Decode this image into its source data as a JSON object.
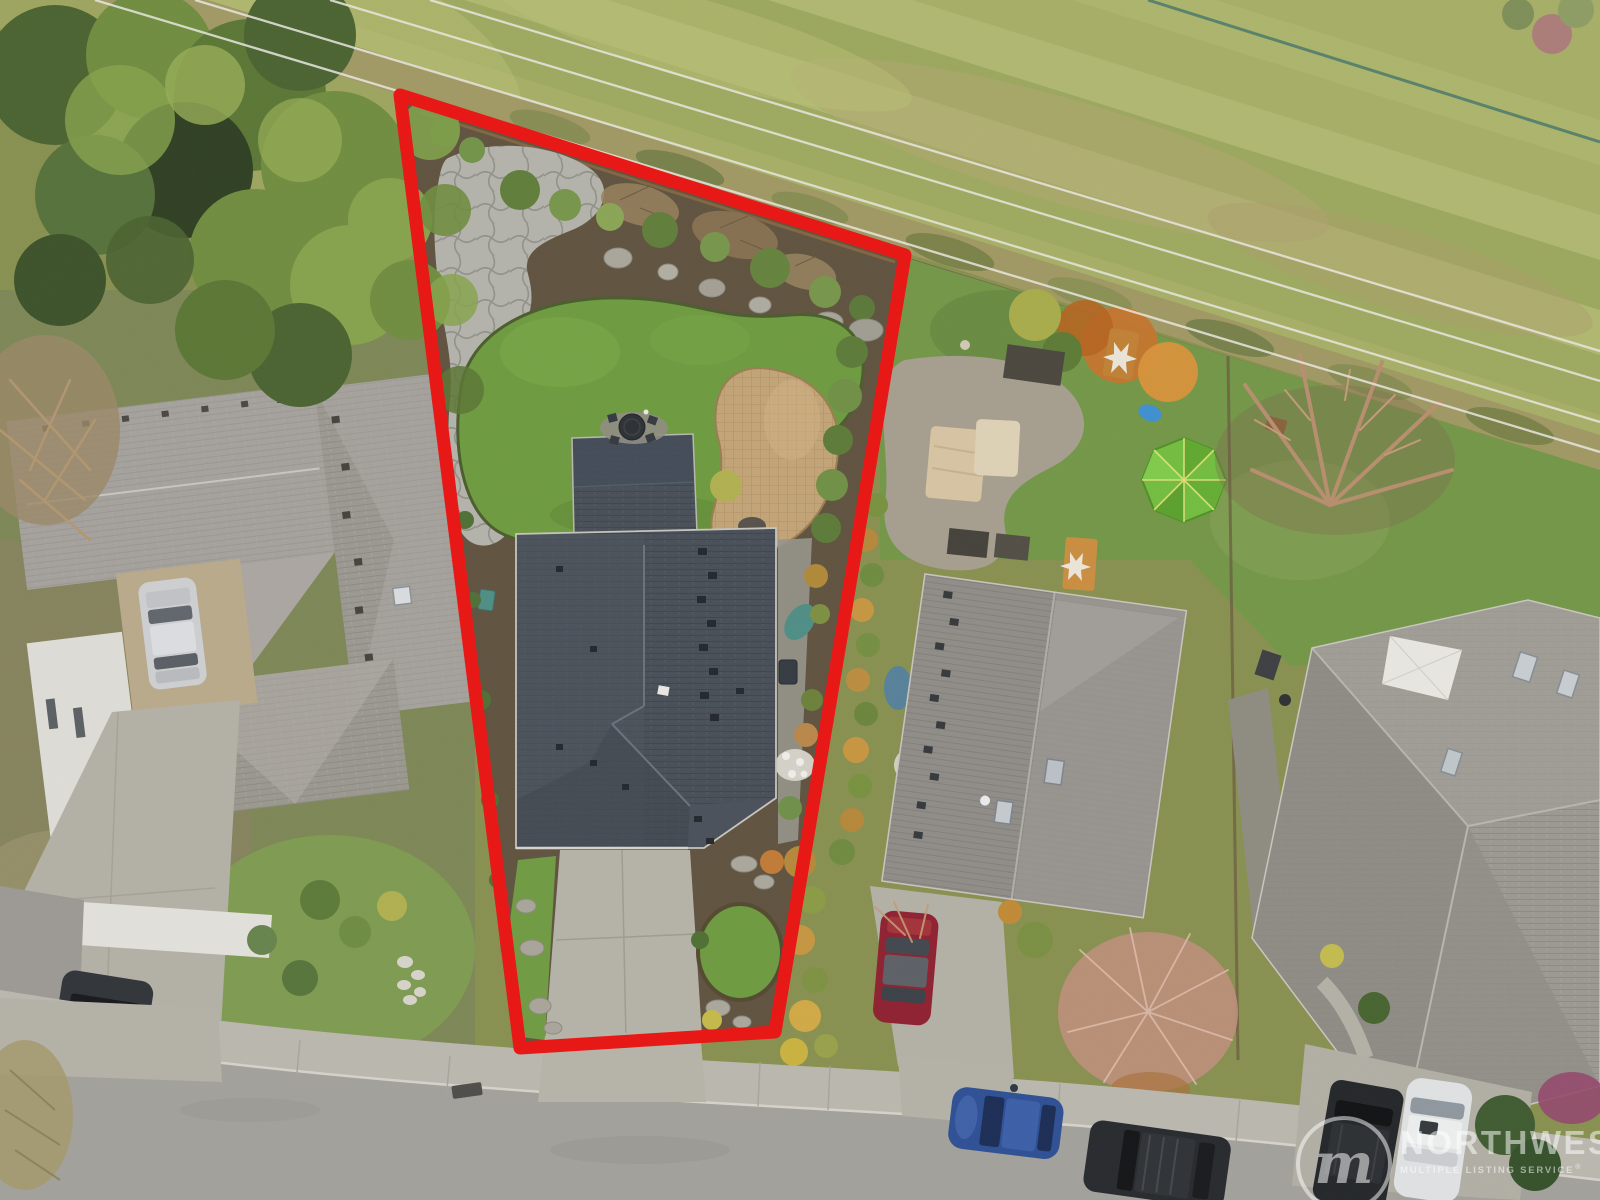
{
  "scene": {
    "kind": "aerial drone photo of residential neighborhood",
    "highlight": "subject lot outlined in red",
    "boundary_color": "#e81412"
  },
  "watermark": {
    "logo_letter": "m",
    "line1": "NORTHWEST",
    "line2": "MULTIPLE LISTING SERVICE",
    "registered": "®",
    "color": "#ffffff"
  },
  "palette": {
    "meadow": "#a5ae66",
    "lawn": "#6d9a3f",
    "subject_roof": "#474d56",
    "neighbor_roof": "#b3aeab",
    "concrete": "#b5b2a8",
    "asphalt": "#a2a09a",
    "patio_pavers": "#c2a377",
    "tent_green": "#72bd3f"
  }
}
